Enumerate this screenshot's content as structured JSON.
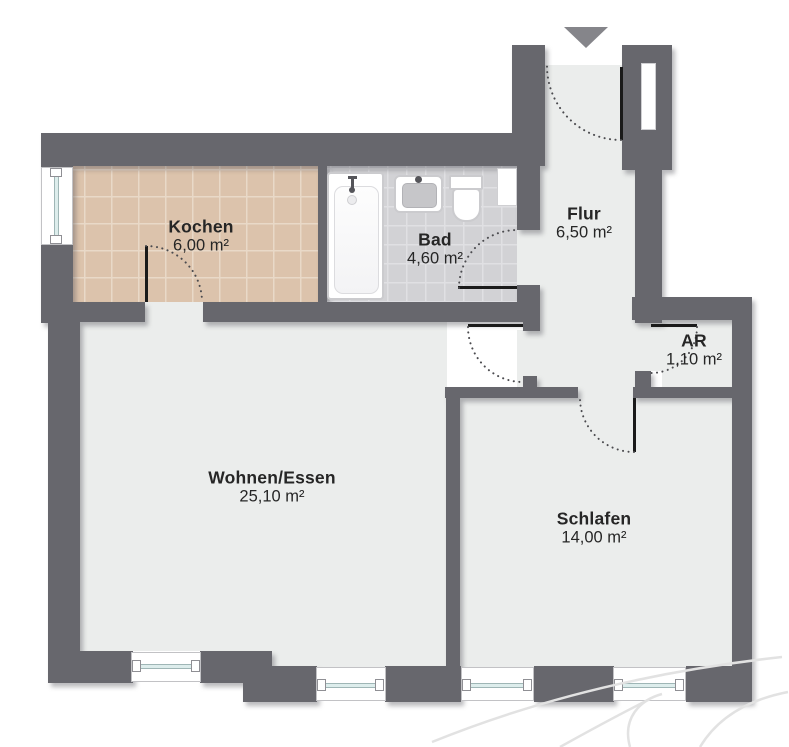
{
  "plan": {
    "rooms": [
      {
        "key": "kochen",
        "name": "Kochen",
        "area": "6,00 m²"
      },
      {
        "key": "bad",
        "name": "Bad",
        "area": "4,60 m²"
      },
      {
        "key": "flur",
        "name": "Flur",
        "area": "6,50 m²"
      },
      {
        "key": "ar",
        "name": "AR",
        "area": "1,10 m²"
      },
      {
        "key": "wohnen",
        "name": "Wohnen/Essen",
        "area": "25,10 m²"
      },
      {
        "key": "schlafen",
        "name": "Schlafen",
        "area": "14,00 m²"
      }
    ],
    "fixtures": [
      {
        "type": "bathtub",
        "room": "bad"
      },
      {
        "type": "sink",
        "room": "bad"
      },
      {
        "type": "toilet",
        "room": "bad"
      }
    ],
    "entrance_icon": "▼",
    "window_count": 5,
    "door_count": 6
  },
  "colors": {
    "wall": "#67676D",
    "floor": "#EBEDEC",
    "kochen-floor": "#DCC3AC",
    "kochen-grid": "#E9D9C8",
    "bad-floor": "#D2D2D5",
    "bad-grid": "#E0E0E3",
    "door": "#1A1A1A",
    "swing": "#4B4B4F",
    "glass": "#DDEDEC",
    "glass-border": "#9FB6B6",
    "fixture-border": "#CBCBCE",
    "arrow": "#85858A",
    "text": "#262626",
    "watermark": "#E2E2E2"
  }
}
